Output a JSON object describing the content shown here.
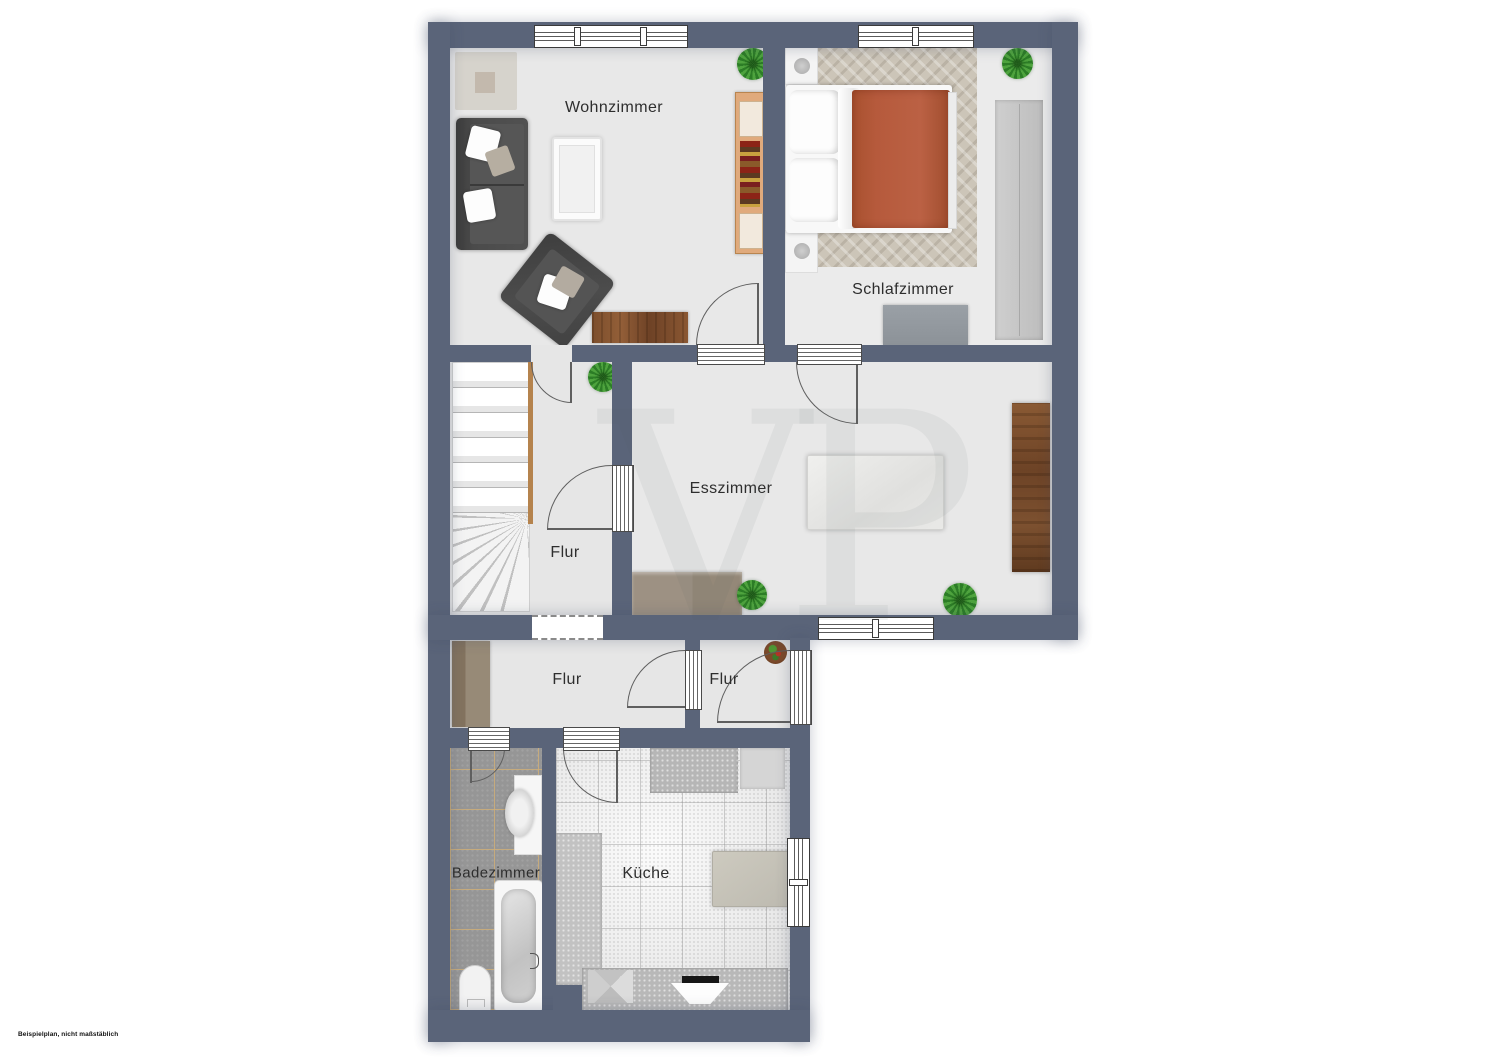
{
  "floorplan": {
    "watermark": "VP",
    "disclaimer": "Beispielplan, nicht maßstäblich",
    "rooms": {
      "wohnzimmer": {
        "label": "Wohnzimmer"
      },
      "schlafzimmer": {
        "label": "Schlafzimmer"
      },
      "esszimmer": {
        "label": "Esszimmer"
      },
      "flur_mitte": {
        "label": "Flur"
      },
      "flur_unten": {
        "label": "Flur"
      },
      "flur_klein": {
        "label": "Flur"
      },
      "badezimmer": {
        "label": "Badezimmer"
      },
      "kueche": {
        "label": "Küche"
      }
    },
    "colors": {
      "wall": "#5a6479",
      "floor_light": "#e8e8e8",
      "bath_tile": "#969696",
      "grout_tan": "#ceae78",
      "bed_blanket": "#b65a3c",
      "wood_light": "#e0aa7c",
      "wood_dark": "#71482a",
      "sideboard_taupe": "#9a8e80",
      "plant_green": "#3f9b33"
    },
    "icons": [
      "sofa",
      "armchair",
      "coffee-table",
      "rug",
      "tv-lowboard",
      "bookcase-sideboard",
      "double-bed",
      "pillow",
      "nightstand",
      "wardrobe",
      "dresser",
      "dining-table",
      "dining-chair",
      "sideboard",
      "lowboard",
      "stairs",
      "hall-wardrobe",
      "potted-plant",
      "washbasin",
      "bathtub",
      "toilet",
      "kitchen-counter",
      "fridge",
      "kitchen-table",
      "kitchen-chair",
      "stove",
      "sink",
      "window",
      "door-swing"
    ]
  }
}
